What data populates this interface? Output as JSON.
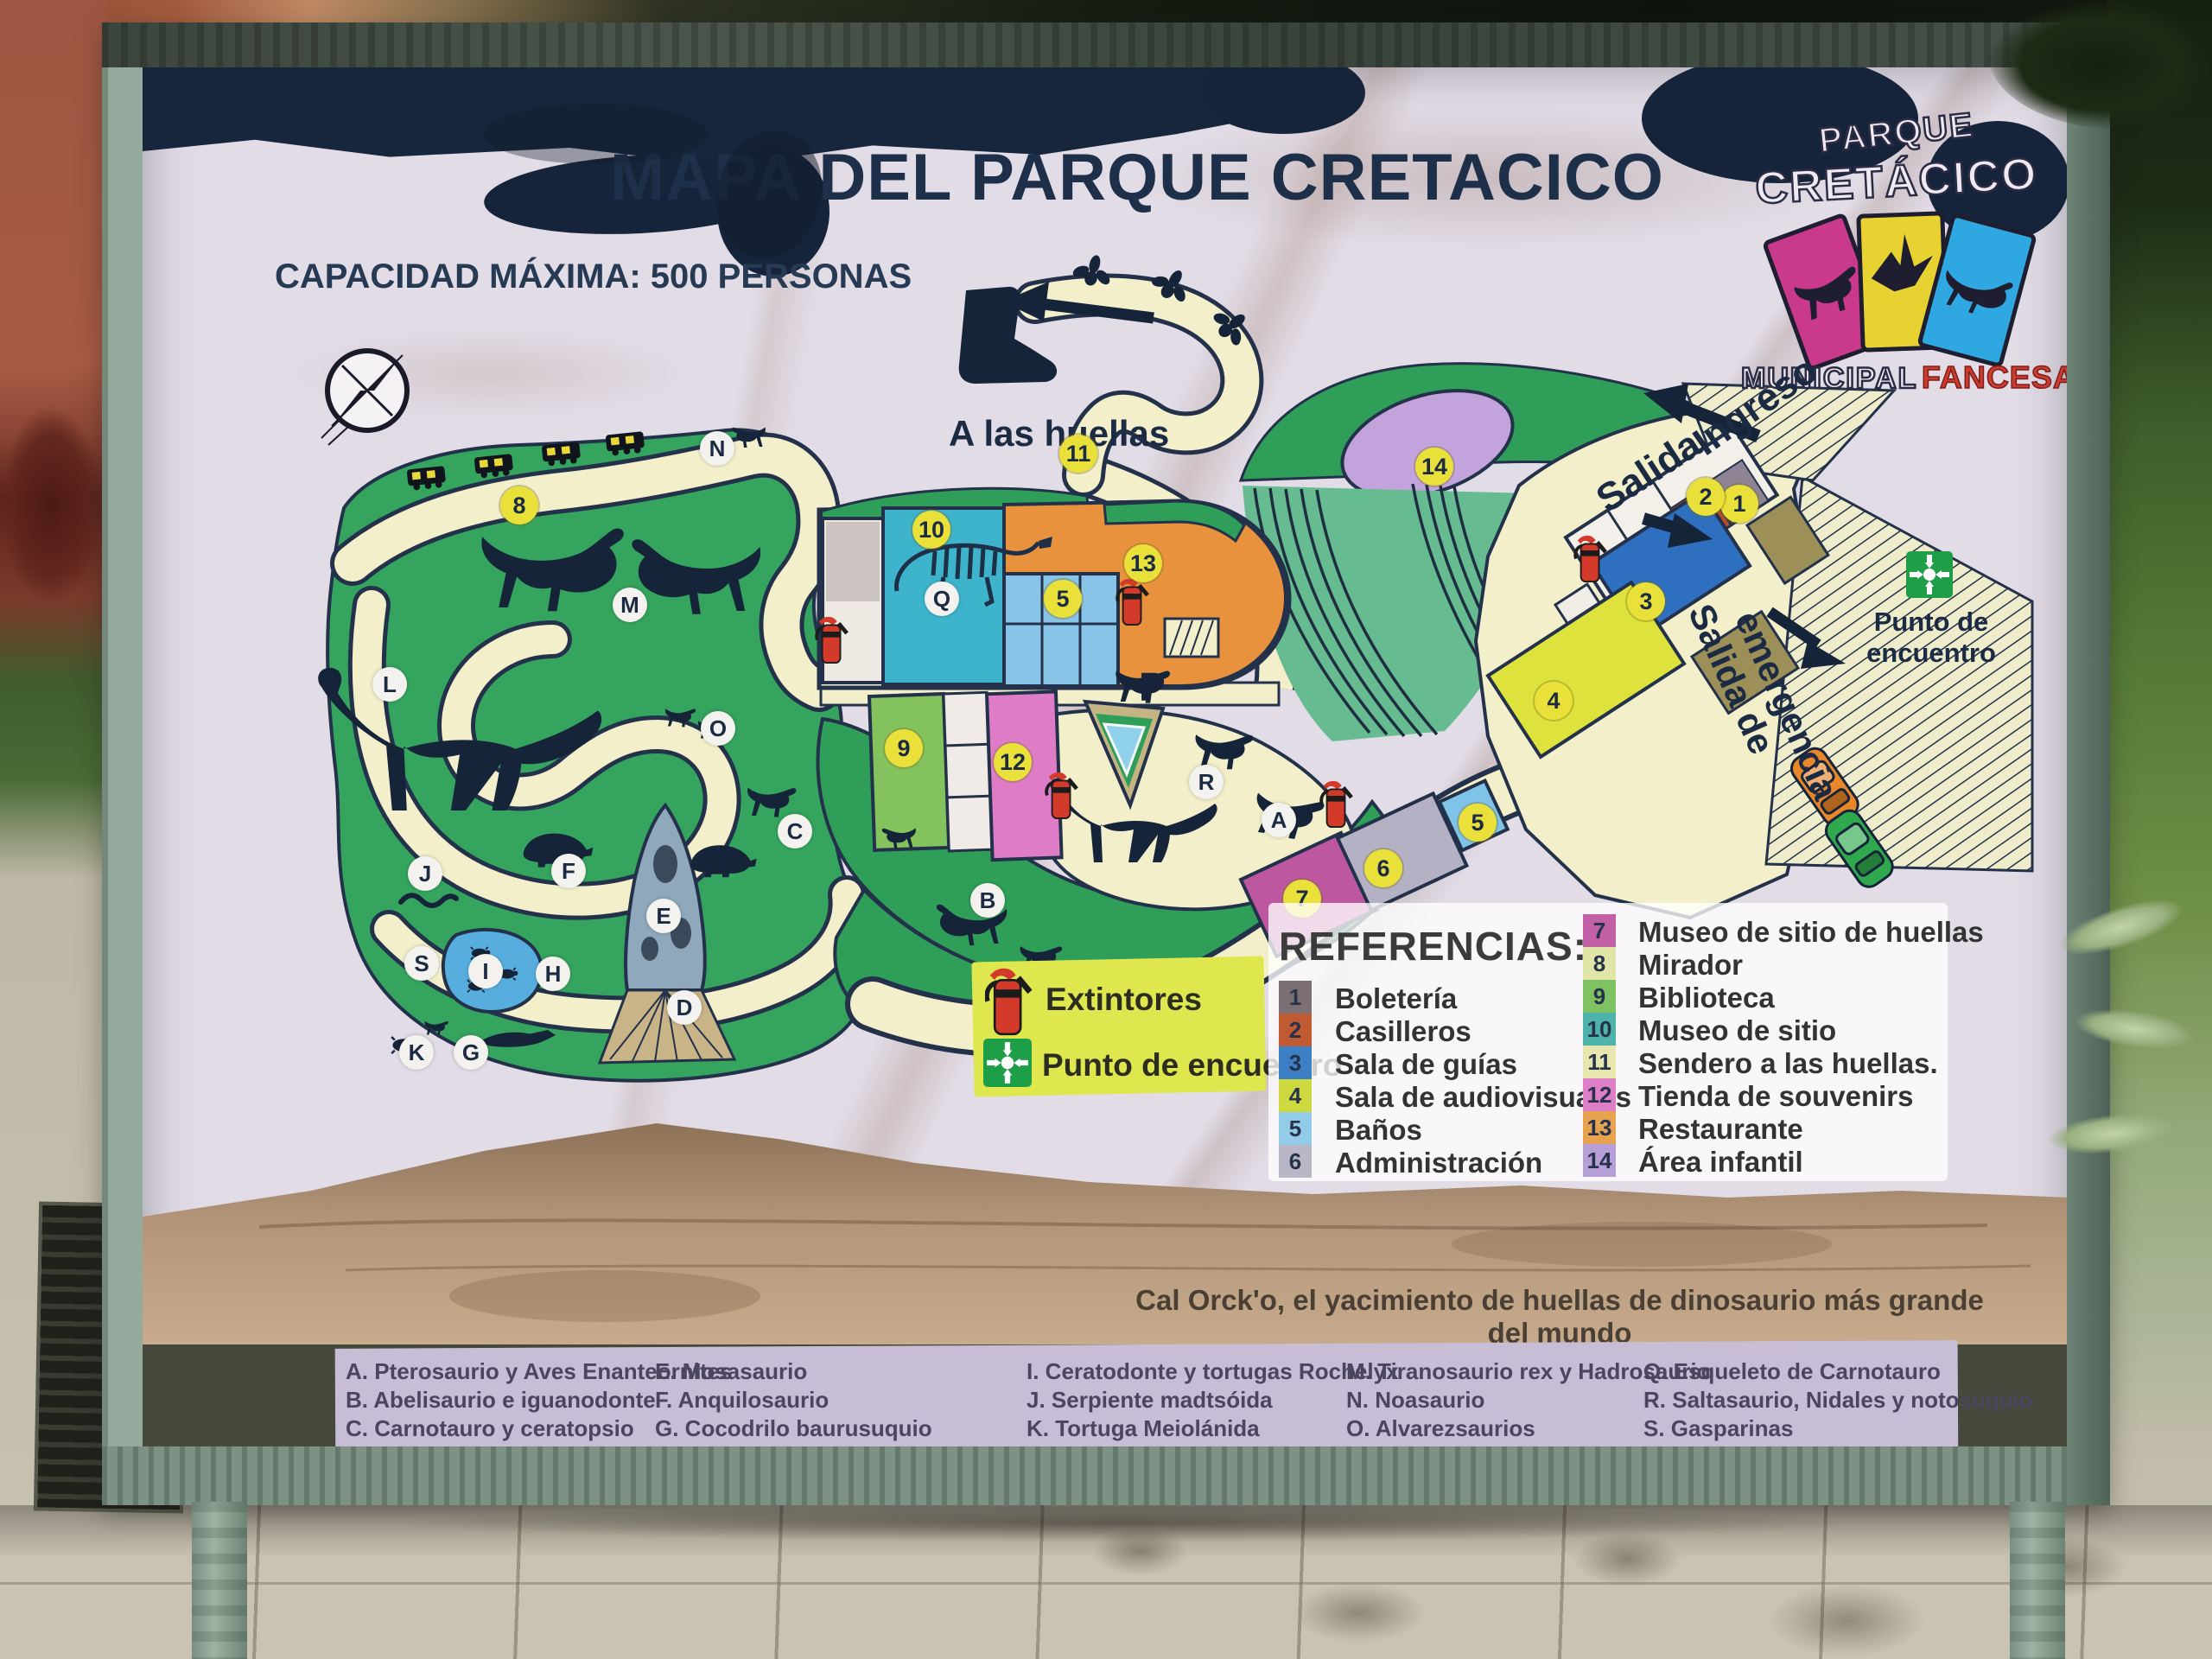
{
  "sign": {
    "title": "MAPA DEL PARQUE CRETACICO",
    "capacity": "CAPACIDAD MÁXIMA: 500 PERSONAS",
    "tagline": "Cal Orck'o, el yacimiento de huellas de dinosaurio más grande del mundo",
    "credit": "DISEÑO: OMAR MEDINA"
  },
  "logo": {
    "park1": "PARQUE",
    "park2": "CRETÁCICO",
    "municipal": "MUNICIPAL",
    "fancesa": "FANCESA"
  },
  "map": {
    "labels": {
      "huellas": "A las huellas",
      "ingreso": "Ingreso",
      "salida": "Salida",
      "salida_emergencia_1": "Salida de",
      "salida_emergencia_2": "emergencia",
      "punto1": "Punto de",
      "punto2": "encuentro"
    },
    "numbers": [
      "1",
      "2",
      "3",
      "4",
      "5",
      "6",
      "7",
      "8",
      "9",
      "10",
      "11",
      "12",
      "13",
      "14"
    ],
    "letters": [
      "A",
      "B",
      "C",
      "D",
      "E",
      "F",
      "G",
      "H",
      "I",
      "J",
      "K",
      "L",
      "M",
      "N",
      "O",
      "P",
      "Q",
      "R",
      "S"
    ]
  },
  "safety": {
    "extintores": "Extintores",
    "punto": "Punto de encuentro"
  },
  "references": {
    "title": "REFERENCIAS:",
    "items": [
      {
        "num": "1",
        "label": "Boletería",
        "color": "#7b6f74"
      },
      {
        "num": "2",
        "label": "Casilleros",
        "color": "#bf5a33"
      },
      {
        "num": "3",
        "label": "Sala de guías",
        "color": "#3d7fc4"
      },
      {
        "num": "4",
        "label": "Sala de audiovisuales",
        "color": "#cdd93e"
      },
      {
        "num": "5",
        "label": "Baños",
        "color": "#92cce8"
      },
      {
        "num": "6",
        "label": "Administración",
        "color": "#b9b7c6"
      },
      {
        "num": "7",
        "label": "Museo de sitio de huellas",
        "color": "#c160a4"
      },
      {
        "num": "8",
        "label": "Mirador",
        "color": "#dfe6a8"
      },
      {
        "num": "9",
        "label": "Biblioteca",
        "color": "#7ec261"
      },
      {
        "num": "10",
        "label": "Museo de sitio",
        "color": "#4db3ab"
      },
      {
        "num": "11",
        "label": "Sendero a las huellas.",
        "color": "#e6e6ae"
      },
      {
        "num": "12",
        "label": "Tienda de souvenirs",
        "color": "#df7ec8"
      },
      {
        "num": "13",
        "label": "Restaurante",
        "color": "#e8a351"
      },
      {
        "num": "14",
        "label": "Área infantil",
        "color": "#b69fd6"
      }
    ]
  },
  "species": {
    "col1": [
      "A. Pterosaurio y Aves Enanteornites",
      "B. Abelisaurio e iguanodonte",
      "C. Carnotauro y ceratopsio",
      "D. Plesiosaurio"
    ],
    "col2": [
      "E. Mosasaurio",
      "F. Anquilosaurio",
      "G. Cocodrilo baurusuquio",
      "H. Esfenodonte, Monotrema y mamífero"
    ],
    "col3": [
      "I. Ceratodonte y tortugas Rochelyx",
      "J. Serpiente madtsóida",
      "K. Tortuga Meiolánida",
      "L. Titanosaurio y cria"
    ],
    "col4": [
      "M. Tiranosaurio rex y Hadrosaurio",
      "N. Noasaurio",
      "O. Alvarezsaurios",
      "P. Unenlagino"
    ],
    "col5": [
      "Q. Esqueleto de Carnotauro",
      "R. Saltasaurio, Nidales y notosuquio",
      "S. Gasparinas"
    ]
  },
  "colors": {
    "frame_green": "#93aa9c",
    "map_green": "#2f9e58",
    "path_cream": "#f2efca",
    "marker_yellow": "#e9e13a",
    "navy": "#1c2b44",
    "fancesa_red": "#cc3a30",
    "logo_card_magenta": "#c93a8c",
    "logo_card_yellow": "#e8d231",
    "logo_card_cyan": "#2fa7e0"
  }
}
